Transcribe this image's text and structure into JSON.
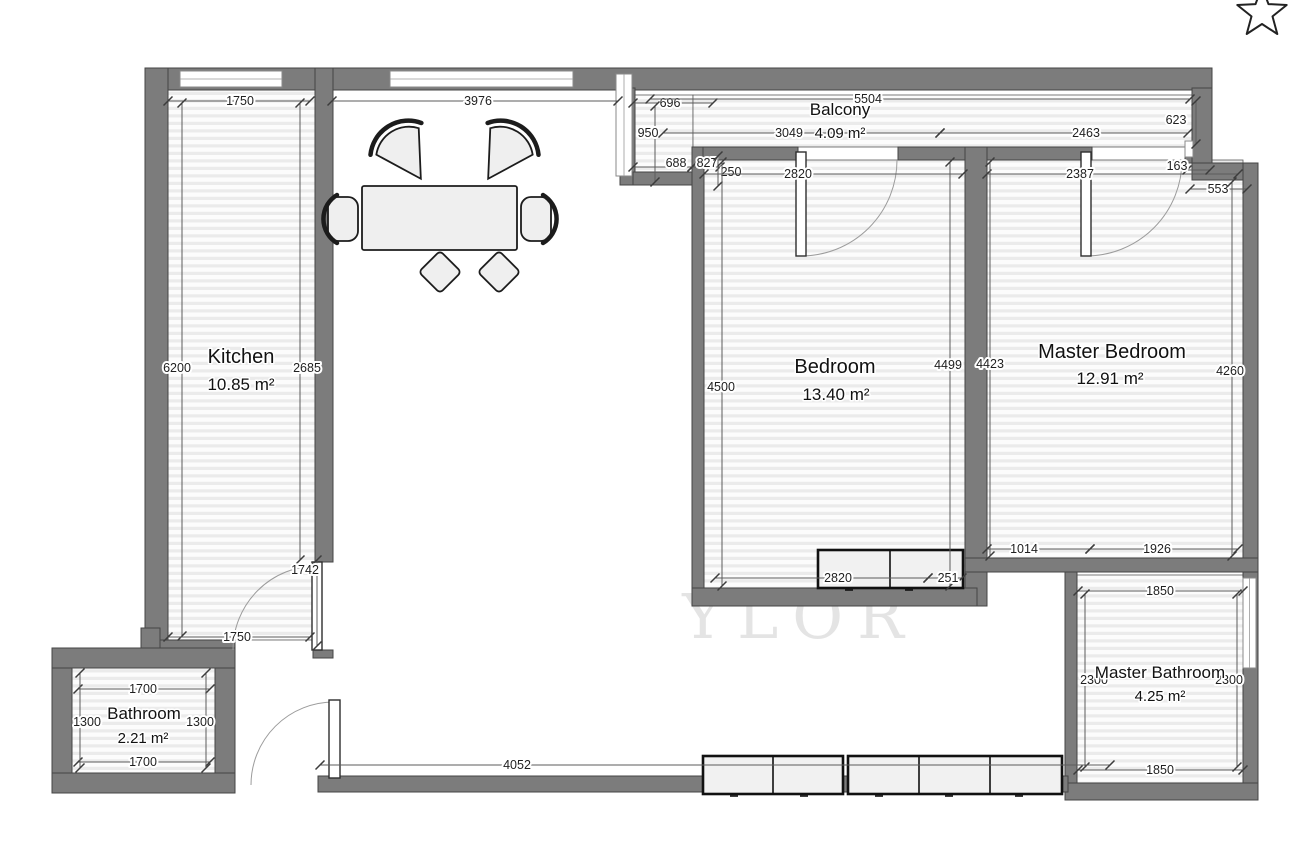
{
  "plan_title": "Apartment floor plan",
  "watermark": "YLOR",
  "favorite_icon": "star-outline-icon",
  "colors": {
    "wall": "#7c7c7c",
    "wall_stroke": "#454545",
    "floor_stripe": "#ebebeb",
    "dimension_text": "#1f1f1f",
    "furniture_fill": "#efefef"
  },
  "rooms": [
    {
      "id": "kitchen",
      "name": "Kitchen",
      "area": "10.85 m²",
      "nx": 241,
      "ny": 363,
      "ax": 241,
      "ay": 390,
      "size": "big"
    },
    {
      "id": "bathroom",
      "name": "Bathroom",
      "area": "2.21 m²",
      "nx": 144,
      "ny": 719,
      "ax": 143,
      "ay": 743,
      "size": "small"
    },
    {
      "id": "bedroom",
      "name": "Bedroom",
      "area": "13.40 m²",
      "nx": 835,
      "ny": 373,
      "ax": 836,
      "ay": 400,
      "size": "big"
    },
    {
      "id": "master-bedroom",
      "name": "Master Bedroom",
      "area": "12.91 m²",
      "nx": 1112,
      "ny": 358,
      "ax": 1110,
      "ay": 384,
      "size": "big"
    },
    {
      "id": "master-bathroom",
      "name": "Master Bathroom",
      "area": "4.25 m²",
      "nx": 1160,
      "ny": 678,
      "ax": 1160,
      "ay": 701,
      "size": "small"
    },
    {
      "id": "balcony",
      "name": "Balcony",
      "area": "4.09 m²",
      "nx": 840,
      "ny": 115,
      "ax": 840,
      "ay": 138,
      "size": "small"
    }
  ],
  "dimensions": [
    {
      "label": "1750",
      "x1": 168,
      "y1": 101,
      "x2": 310,
      "y2": 101,
      "lx": 240,
      "ly": 101
    },
    {
      "label": "3976",
      "x1": 332,
      "y1": 101,
      "x2": 618,
      "y2": 101,
      "lx": 478,
      "ly": 101
    },
    {
      "label": "696",
      "x1": 633,
      "y1": 103,
      "x2": 713,
      "y2": 103,
      "lx": 670,
      "ly": 103
    },
    {
      "label": "5504",
      "x1": 650,
      "y1": 99,
      "x2": 1190,
      "y2": 99,
      "lx": 868,
      "ly": 99
    },
    {
      "label": "950",
      "x1": 655,
      "y1": 106,
      "x2": 655,
      "y2": 182,
      "lx": 648,
      "ly": 133
    },
    {
      "label": "3049",
      "x1": 663,
      "y1": 133,
      "x2": 940,
      "y2": 133,
      "lx": 789,
      "ly": 133
    },
    {
      "label": "2463",
      "x1": 940,
      "y1": 133,
      "x2": 1188,
      "y2": 133,
      "lx": 1086,
      "ly": 133
    },
    {
      "label": "623",
      "x1": 1196,
      "y1": 101,
      "x2": 1196,
      "y2": 144,
      "lx": 1176,
      "ly": 120
    },
    {
      "label": "688",
      "x1": 633,
      "y1": 167,
      "x2": 692,
      "y2": 167,
      "lx": 676,
      "ly": 163
    },
    {
      "label": "827",
      "x1": 692,
      "y1": 167,
      "x2": 720,
      "y2": 167,
      "lx": 707,
      "ly": 163
    },
    {
      "label": "250",
      "x1": 718,
      "y1": 156,
      "x2": 718,
      "y2": 186,
      "lx": 731,
      "ly": 172
    },
    {
      "label": "2820",
      "x1": 704,
      "y1": 174,
      "x2": 963,
      "y2": 174,
      "lx": 798,
      "ly": 174
    },
    {
      "label": "2387",
      "x1": 987,
      "y1": 174,
      "x2": 1238,
      "y2": 174,
      "lx": 1080,
      "ly": 174
    },
    {
      "label": "163",
      "x1": 1187,
      "y1": 170,
      "x2": 1210,
      "y2": 170,
      "lx": 1177,
      "ly": 166
    },
    {
      "label": "553",
      "x1": 1190,
      "y1": 189,
      "x2": 1247,
      "y2": 189,
      "lx": 1218,
      "ly": 189
    },
    {
      "label": "6200",
      "x1": 182,
      "y1": 103,
      "x2": 182,
      "y2": 636,
      "lx": 177,
      "ly": 368
    },
    {
      "label": "2685",
      "x1": 300,
      "y1": 103,
      "x2": 300,
      "y2": 560,
      "lx": 307,
      "ly": 368
    },
    {
      "label": "1742",
      "x1": 317,
      "y1": 560,
      "x2": 317,
      "y2": 646,
      "lx": 305,
      "ly": 570
    },
    {
      "label": "1750",
      "x1": 168,
      "y1": 637,
      "x2": 310,
      "y2": 637,
      "lx": 237,
      "ly": 637
    },
    {
      "label": "4500",
      "x1": 722,
      "y1": 162,
      "x2": 722,
      "y2": 586,
      "lx": 721,
      "ly": 387
    },
    {
      "label": "4499",
      "x1": 950,
      "y1": 162,
      "x2": 950,
      "y2": 586,
      "lx": 948,
      "ly": 365
    },
    {
      "label": "4423",
      "x1": 990,
      "y1": 162,
      "x2": 990,
      "y2": 556,
      "lx": 990,
      "ly": 364
    },
    {
      "label": "4260",
      "x1": 1232,
      "y1": 182,
      "x2": 1232,
      "y2": 556,
      "lx": 1230,
      "ly": 371
    },
    {
      "label": "1014",
      "x1": 987,
      "y1": 549,
      "x2": 1090,
      "y2": 549,
      "lx": 1024,
      "ly": 549
    },
    {
      "label": "1926",
      "x1": 1090,
      "y1": 549,
      "x2": 1238,
      "y2": 549,
      "lx": 1157,
      "ly": 549
    },
    {
      "label": "2820",
      "x1": 715,
      "y1": 578,
      "x2": 928,
      "y2": 578,
      "lx": 838,
      "ly": 578
    },
    {
      "label": "251",
      "x1": 928,
      "y1": 578,
      "x2": 962,
      "y2": 578,
      "lx": 948,
      "ly": 578
    },
    {
      "label": "1850",
      "x1": 1078,
      "y1": 591,
      "x2": 1243,
      "y2": 591,
      "lx": 1160,
      "ly": 591
    },
    {
      "label": "1850",
      "x1": 1078,
      "y1": 770,
      "x2": 1243,
      "y2": 770,
      "lx": 1160,
      "ly": 770
    },
    {
      "label": "2300",
      "x1": 1085,
      "y1": 594,
      "x2": 1085,
      "y2": 767,
      "lx": 1094,
      "ly": 680
    },
    {
      "label": "2300",
      "x1": 1237,
      "y1": 594,
      "x2": 1237,
      "y2": 767,
      "lx": 1229,
      "ly": 680
    },
    {
      "label": "1700",
      "x1": 78,
      "y1": 689,
      "x2": 210,
      "y2": 689,
      "lx": 143,
      "ly": 689
    },
    {
      "label": "1700",
      "x1": 78,
      "y1": 762,
      "x2": 210,
      "y2": 762,
      "lx": 143,
      "ly": 762
    },
    {
      "label": "1300",
      "x1": 80,
      "y1": 673,
      "x2": 80,
      "y2": 768,
      "lx": 87,
      "ly": 722
    },
    {
      "label": "1300",
      "x1": 206,
      "y1": 673,
      "x2": 206,
      "y2": 768,
      "lx": 200,
      "ly": 722
    },
    {
      "label": "4052",
      "x1": 320,
      "y1": 765,
      "x2": 1110,
      "y2": 765,
      "lx": 517,
      "ly": 765
    }
  ]
}
